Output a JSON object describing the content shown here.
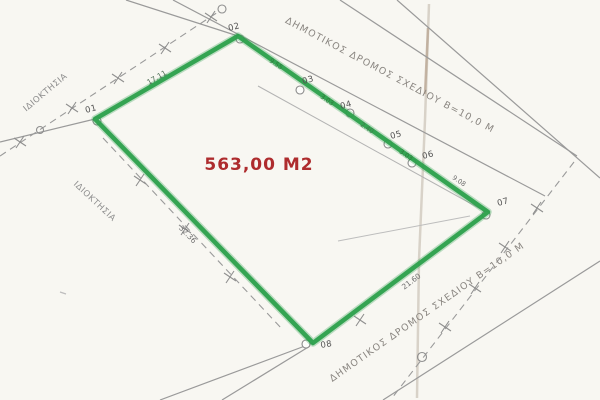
{
  "plan": {
    "area_label": "563,00 M2",
    "labels": {
      "road_top": "ΔΗΜΟΤΙΚΟΣ ΔΡΟΜΟΣ ΣΧΕΔΙΟΥ Β=10,0 Μ",
      "road_bottom": "ΔΗΜΟΤΙΚΟΣ ΔΡΟΜΟΣ ΣΧΕΔΙΟΥ Β=10,0 Μ",
      "ownership_upper": "ΙΔΙΟΚΤΗΣΙΑ",
      "ownership_lower": "ΙΔΙΟΚΤΗΣΙΑ"
    },
    "points": [
      {
        "id": "01"
      },
      {
        "id": "02"
      },
      {
        "id": "03"
      },
      {
        "id": "04"
      },
      {
        "id": "05"
      },
      {
        "id": "06"
      },
      {
        "id": "07"
      },
      {
        "id": "08"
      }
    ],
    "dimensions": {
      "edge_01_02": "17.11",
      "seg_02_03": "9.55",
      "seg_03_04": "3.03",
      "seg_04_05": "2.40",
      "seg_05_06": "3.03",
      "seg_06_07": "9.08",
      "edge_07_08": "21.60",
      "edge_08_01": "32.36"
    },
    "colors": {
      "parcel_outline": "#2ca04c",
      "area_text": "#ae2c2e",
      "drawing_lines": "#9a9a9a"
    }
  }
}
